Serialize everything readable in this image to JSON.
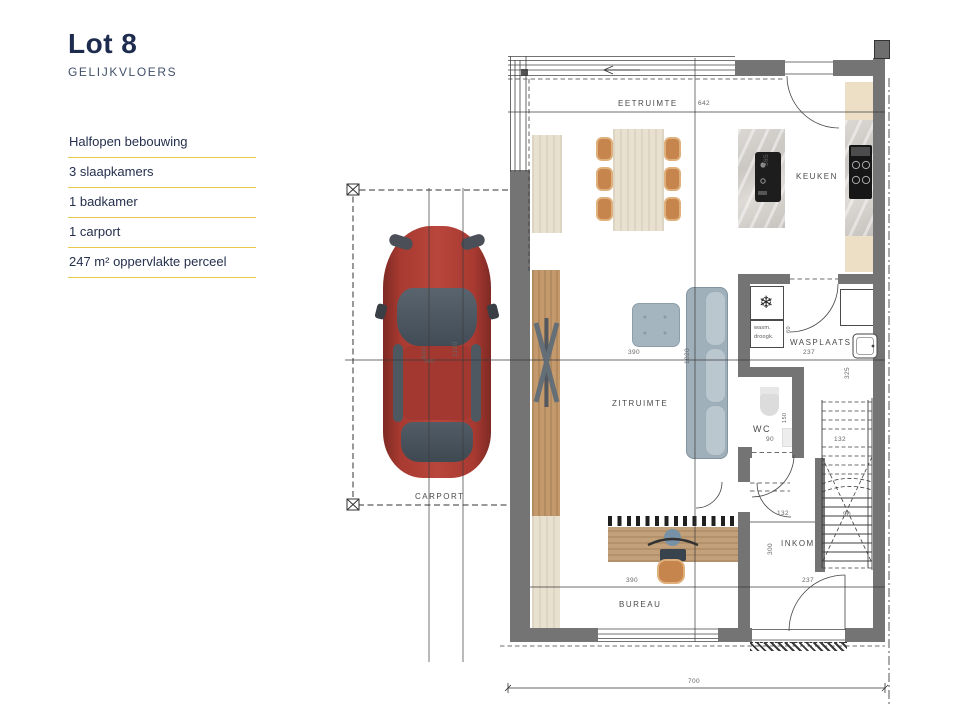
{
  "sidebar": {
    "title": "Lot 8",
    "subtitle": "GELIJKVLOERS",
    "features": [
      {
        "label": "Halfopen bebouwing"
      },
      {
        "label": "3 slaapkamers"
      },
      {
        "label": "1 badkamer"
      },
      {
        "label": "1 carport"
      },
      {
        "label": "247 m² oppervlakte perceel"
      }
    ],
    "accent_color": "#e9c84e",
    "title_color": "#1d2b4f"
  },
  "plan": {
    "rooms": {
      "eetruimte": "EETRUIMTE",
      "keuken": "KEUKEN",
      "wasplaats": "WASPLAATS",
      "zitruimte": "ZITRUIMTE",
      "wc": "WC",
      "inkom": "INKOM",
      "bureau": "BUREAU",
      "carport": "CARPORT"
    },
    "appliances": {
      "washer": "wasm.",
      "dryer": "droogk.",
      "freezer_icon": "❄"
    },
    "dims": {
      "eetruimte_width": "642",
      "island_length": "365",
      "zitruimte_width": "390",
      "living_depth": "1020",
      "carport_length": "600",
      "carport_mid": "340",
      "carport_total": "1100",
      "wasplaats_width": "237",
      "wasplaats_depth": "325",
      "washer_width": "60",
      "wc_width": "90",
      "wc_depth": "150",
      "stair_upper": "132",
      "stair_width": "90",
      "inkom_width": "132",
      "inkom_depth": "300",
      "inkom_bottom": "237",
      "bureau_width": "390",
      "total_width": "700"
    }
  }
}
